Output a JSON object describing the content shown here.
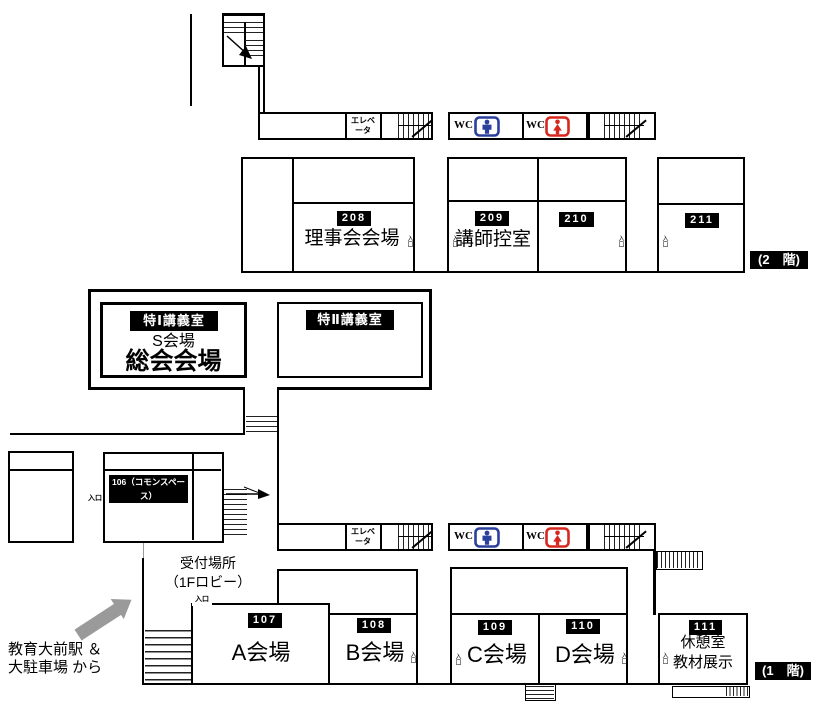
{
  "labels": {
    "entrance": "入口",
    "wc": "WC",
    "elevator_line1": "エレベ",
    "elevator_line2": "ータ"
  },
  "floor2": {
    "badge": "(2　階)",
    "rooms": [
      {
        "number": "208",
        "name": "理事会会場"
      },
      {
        "number": "209",
        "name": "講師控室"
      },
      {
        "number": "210",
        "name": ""
      },
      {
        "number": "211",
        "name": ""
      }
    ],
    "special_left": {
      "tag": "特Ⅰ講義室",
      "line1": "S会場",
      "line2": "総会会場"
    },
    "special_right": {
      "tag": "特Ⅱ講義室"
    }
  },
  "floor1": {
    "badge": "(1　階)",
    "commons_tag": "106（コモンスペース）",
    "reception": {
      "line1": "受付場所",
      "line2": "（1Fロビー）"
    },
    "access": {
      "line1": "教育大前駅 ＆",
      "line2": "大駐車場 から"
    },
    "rooms": [
      {
        "number": "107",
        "name": "A会場"
      },
      {
        "number": "108",
        "name": "B会場"
      },
      {
        "number": "109",
        "name": "C会場"
      },
      {
        "number": "110",
        "name": "D会場"
      },
      {
        "number": "111",
        "name": "休憩室",
        "name2": "教材展示"
      }
    ]
  },
  "colors": {
    "wc_male": "#2B3F9C",
    "wc_female": "#D6281E",
    "arrow": "#9A9A9A",
    "wall": "#000000"
  }
}
